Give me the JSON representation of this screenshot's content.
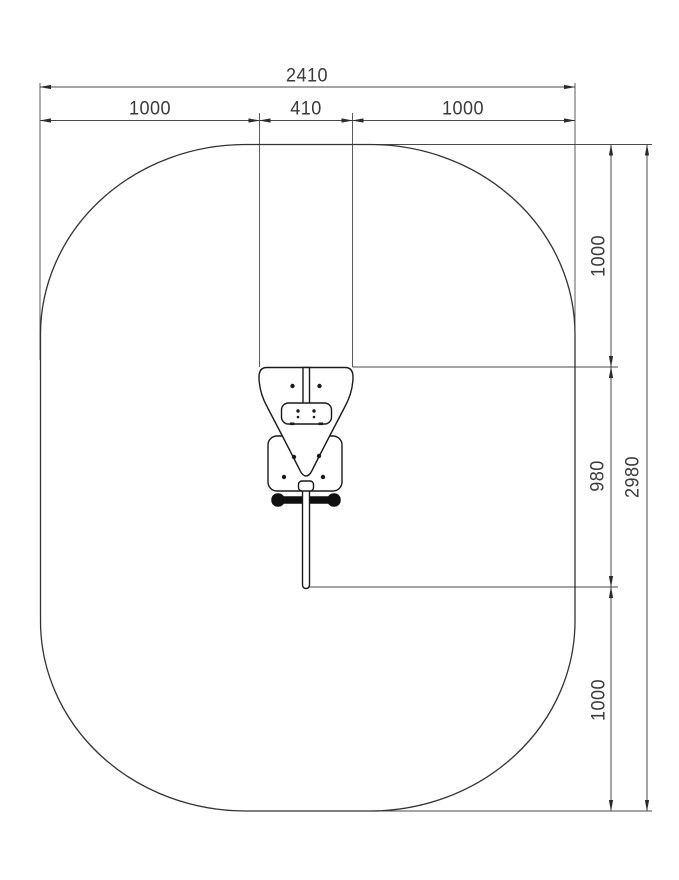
{
  "drawing": {
    "description": "top-view installation drawing of outdoor fitness equipment with safety clearance area",
    "labels": {
      "top_overall": "2410",
      "top_left": "1000",
      "top_center": "410",
      "top_right": "1000",
      "right_top": "1000",
      "right_middle": "980",
      "right_bottom": "1000",
      "right_overall": "2980"
    },
    "dimension_rows": {
      "top": [
        "1000",
        "410",
        "1000"
      ],
      "right": [
        "1000",
        "980",
        "1000"
      ]
    },
    "colors": {
      "background": "#ffffff",
      "line": "#2a2a2a",
      "dimension_line": "#4a4a4a",
      "text": "#3a3a3a"
    }
  }
}
